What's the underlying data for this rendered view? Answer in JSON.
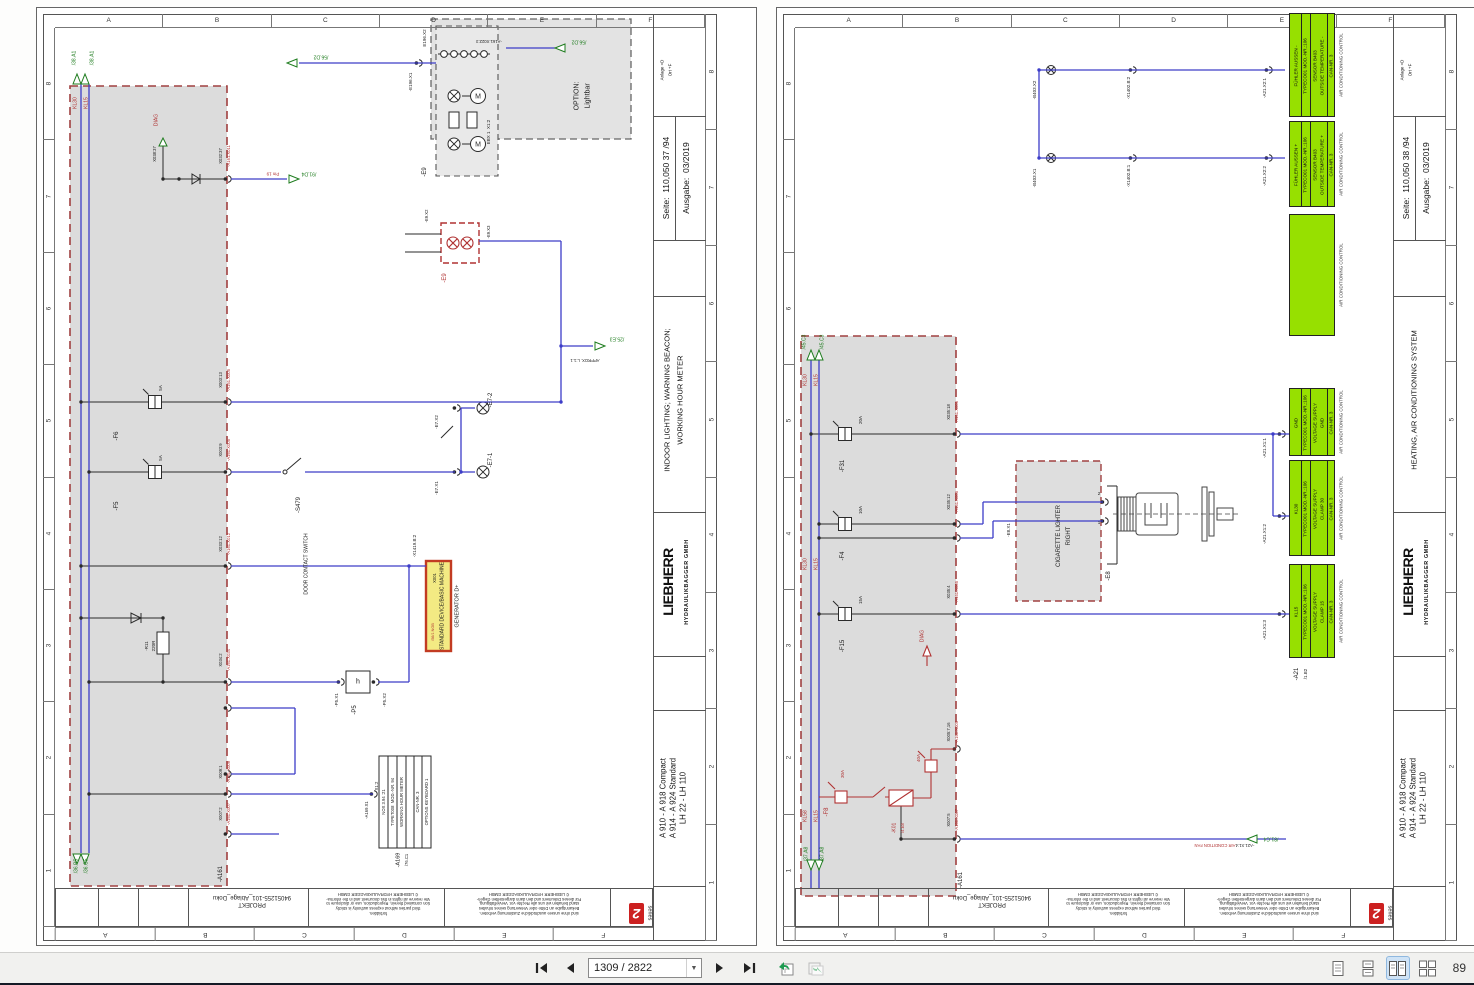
{
  "toolbar": {
    "page_input": "1309 / 2822",
    "zoom_value": "89"
  },
  "sheet_letters": [
    "A",
    "B",
    "C",
    "D",
    "E",
    "F"
  ],
  "sheet_numbers": [
    "8",
    "7",
    "6",
    "5",
    "4",
    "3",
    "2",
    "1"
  ],
  "footer_shared": {
    "projekt_lines": [
      "PROJEKT",
      "94051255-101_Ablage_Doku"
    ],
    "copyright_en": [
      "forbidden.",
      "third parties without express authority is strictly",
      "tion contained therein. Reproduction, use or disclosure to",
      "We reserve all rights in this document and in the informa-",
      "© LIEBHERR HYDRAULIKBAGGER GMBH"
    ],
    "copyright_de": [
      "sind ohne unsere ausdrückliche Zustimmung verboten.",
      "Bekanntgabe an Dritte oder Verwertung seines Inhaltes",
      "stand behalten wir uns alle Rechte vor. Vervielfältigung,",
      "Für dieses Dokument und den darin dargestellten Gegen-",
      "© LIEBHERR HYDRAULIKBAGGER GMBH"
    ],
    "series_word": "series",
    "series_digit": "2"
  },
  "pages": [
    {
      "sheet_id": "110.050 37",
      "title_block": {
        "anlage": "Anlage   =D",
        "ort": "Ort   +F",
        "seite_label": "Seite:",
        "seite_value": "110,050 37   /94",
        "ausgabe_label": "Ausgabe:",
        "ausgabe_value": "03/2019",
        "description_lines": [
          "INDOOR LIGHTING; WARNING BEACON;",
          "WORKING HOUR METER"
        ],
        "brand": "LIEBHERR",
        "brand_sub": "HYDRAULIKBAGGER  GMBH",
        "models": [
          "A 910 - A 918 Compact",
          "A 914 - A 924 Standard",
          "LH 22 - LH 110"
        ]
      },
      "labels": [
        {
          "t": "/38.A1",
          "x": 38,
          "y": 50,
          "c": "g"
        },
        {
          "t": "/38.A1",
          "x": 56,
          "y": 50,
          "c": "g"
        },
        {
          "t": "KL30",
          "x": 39,
          "y": 95,
          "c": "r"
        },
        {
          "t": "KL15",
          "x": 50,
          "y": 95,
          "c": "r"
        },
        {
          "t": "DIAG",
          "x": 120,
          "y": 112,
          "c": "r"
        },
        {
          "t": "X038:37",
          "x": 118,
          "y": 146,
          "c": "k",
          "s": 4.2
        },
        {
          "t": "X032:37",
          "x": 184,
          "y": 148,
          "c": "k",
          "s": 4.2
        },
        {
          "t": "-A161.X011",
          "x": 192,
          "y": 148,
          "c": "r",
          "s": 4.2
        },
        {
          "t": "Pin 19",
          "x": 236,
          "y": 165,
          "c": "r",
          "r": "u",
          "s": 4.5
        },
        {
          "t": "/91.D4",
          "x": 272,
          "y": 165,
          "c": "g",
          "r": "u"
        },
        {
          "t": "/56.D2",
          "x": 284,
          "y": 48,
          "c": "g",
          "r": "u"
        },
        {
          "t": "-E196.X1",
          "x": 374,
          "y": 74,
          "c": "k",
          "s": 4.5
        },
        {
          "t": "E196.X2",
          "x": 388,
          "y": 30,
          "c": "k",
          "s": 4.5
        },
        {
          "t": "EBX 1  X1:2",
          "x": 452,
          "y": 124,
          "c": "k",
          "s": 4.5
        },
        {
          "t": "OPTION:",
          "x": 540,
          "y": 88,
          "c": "k",
          "s": 7
        },
        {
          "t": "Lightbar",
          "x": 551,
          "y": 88,
          "c": "k",
          "s": 7
        },
        {
          "t": "-E9",
          "x": 388,
          "y": 164,
          "c": "k",
          "s": 6
        },
        {
          "t": "/56.D2",
          "x": 542,
          "y": 33,
          "c": "g",
          "r": "u"
        },
        {
          "t": "-A161.X022:3",
          "x": 452,
          "y": 33,
          "c": "k",
          "r": "u",
          "s": 4.2
        },
        {
          "t": "-E9.X2",
          "x": 390,
          "y": 208,
          "c": "k",
          "s": 4.2
        },
        {
          "t": "-E9.X3",
          "x": 452,
          "y": 224,
          "c": "k",
          "s": 4.2
        },
        {
          "t": "-E9",
          "x": 408,
          "y": 270,
          "c": "r",
          "s": 6
        },
        {
          "t": "/25.E3",
          "x": 580,
          "y": 330,
          "c": "g",
          "r": "u"
        },
        {
          "t": "APPROX. L:1.1",
          "x": 548,
          "y": 352,
          "c": "k",
          "r": "u",
          "s": 4.2
        },
        {
          "t": "-E7-2",
          "x": 454,
          "y": 392,
          "c": "k",
          "s": 6
        },
        {
          "t": "-E7.X2",
          "x": 400,
          "y": 414,
          "c": "k",
          "s": 4.5
        },
        {
          "t": "-E7-1",
          "x": 454,
          "y": 452,
          "c": "k",
          "s": 6
        },
        {
          "t": "-E7.X1",
          "x": 400,
          "y": 480,
          "c": "k",
          "s": 4.5
        },
        {
          "t": "-S479",
          "x": 262,
          "y": 497,
          "c": "k",
          "s": 6
        },
        {
          "t": "DOOR CONTACT SWITCH",
          "x": 270,
          "y": 556,
          "c": "k",
          "s": 5
        },
        {
          "t": "-F6",
          "x": 80,
          "y": 428,
          "c": "k",
          "s": 6
        },
        {
          "t": "5A",
          "x": 124,
          "y": 380,
          "c": "k",
          "s": 4.5
        },
        {
          "t": "-F5",
          "x": 80,
          "y": 498,
          "c": "k",
          "s": 6
        },
        {
          "t": "5A",
          "x": 124,
          "y": 450,
          "c": "k",
          "s": 4.5
        },
        {
          "t": "-R11",
          "x": 110,
          "y": 638,
          "c": "k",
          "s": 4.5
        },
        {
          "t": "220R",
          "x": 117,
          "y": 638,
          "c": "k",
          "s": 4.5
        },
        {
          "t": "-P5",
          "x": 318,
          "y": 702,
          "c": "k",
          "s": 6
        },
        {
          "t": "-P5.X1",
          "x": 300,
          "y": 692,
          "c": "k",
          "s": 4.5
        },
        {
          "t": "-P5.X2",
          "x": 348,
          "y": 692,
          "c": "k",
          "s": 4.5
        },
        {
          "t": "h",
          "x": 321,
          "y": 674,
          "c": "k",
          "r": "h",
          "s": 7
        },
        {
          "t": "-X1419.B:2",
          "x": 378,
          "y": 538,
          "c": "k",
          "s": 4.5
        },
        {
          "t": "X001",
          "x": 398,
          "y": 570,
          "c": "k",
          "s": 4.2
        },
        {
          "t": "/56/1 NGB",
          "x": 397,
          "y": 624,
          "c": "r",
          "s": 3.8
        },
        {
          "t": "STANDARD DEVICE/BASIC MACHINE",
          "x": 406,
          "y": 598,
          "c": "k",
          "s": 5
        },
        {
          "t": "GENERATOR D+",
          "x": 421,
          "y": 598,
          "c": "k",
          "s": 5.5
        },
        {
          "t": "NOX 3.94 :21",
          "x": 347,
          "y": 794,
          "c": "k",
          "s": 4.2
        },
        {
          "t": "TYPET008  MOD.-NR. 94",
          "x": 356,
          "y": 794,
          "c": "k",
          "s": 4.2
        },
        {
          "t": "WORKING HOUR METER",
          "x": 365,
          "y": 794,
          "c": "k",
          "s": 4.2
        },
        {
          "t": "CAN-NR. 3",
          "x": 381,
          "y": 794,
          "c": "k",
          "s": 4.2
        },
        {
          "t": "OPTIONS KEYBOARD 1",
          "x": 390,
          "y": 794,
          "c": "k",
          "s": 4.2
        },
        {
          "t": "-A169",
          "x": 362,
          "y": 852,
          "c": "k",
          "s": 5.5
        },
        {
          "t": "/76.C1",
          "x": 370,
          "y": 852,
          "c": "k",
          "s": 4.2
        },
        {
          "t": "-A169.X1",
          "x": 330,
          "y": 802,
          "c": "k",
          "s": 4.2
        },
        {
          "t": "X1:2",
          "x": 340,
          "y": 778,
          "c": "k",
          "s": 4.2
        },
        {
          "t": "-A161",
          "x": 184,
          "y": 866,
          "c": "k",
          "s": 6
        },
        {
          "t": "X003:13",
          "x": 184,
          "y": 372,
          "c": "k",
          "s": 4.2
        },
        {
          "t": "-A161.X005",
          "x": 192,
          "y": 372,
          "c": "r",
          "s": 4.2
        },
        {
          "t": "X003:9",
          "x": 184,
          "y": 442,
          "c": "k",
          "s": 4.2
        },
        {
          "t": "-A161.X005",
          "x": 192,
          "y": 442,
          "c": "r",
          "s": 4.2
        },
        {
          "t": "X033:12",
          "x": 184,
          "y": 536,
          "c": "k",
          "s": 4.2
        },
        {
          "t": "-A161.X012",
          "x": 192,
          "y": 536,
          "c": "r",
          "s": 4.2
        },
        {
          "t": "X034:2",
          "x": 184,
          "y": 652,
          "c": "k",
          "s": 4.2
        },
        {
          "t": "-A161.X034",
          "x": 192,
          "y": 652,
          "c": "r",
          "s": 4.2
        },
        {
          "t": "X009:1",
          "x": 184,
          "y": 764,
          "c": "k",
          "s": 4.2
        },
        {
          "t": "-A161.X009",
          "x": 192,
          "y": 764,
          "c": "r",
          "s": 4.2
        },
        {
          "t": "X007:2",
          "x": 184,
          "y": 806,
          "c": "k",
          "s": 4.2
        },
        {
          "t": "-A161.X007",
          "x": 192,
          "y": 806,
          "c": "r",
          "s": 4.2
        },
        {
          "t": "/36.B5",
          "x": 40,
          "y": 858,
          "c": "g"
        },
        {
          "t": "/36.C5",
          "x": 50,
          "y": 858,
          "c": "g"
        }
      ]
    },
    {
      "sheet_id": "110.050 38",
      "title_block": {
        "anlage": "Anlage   =D",
        "ort": "Ort   +F",
        "seite_label": "Seite:",
        "seite_value": "110,050 38   /94",
        "ausgabe_label": "Ausgabe:",
        "ausgabe_value": "03/2019",
        "description_lines": [
          "HEATING, AIR CONDITIONING SYSTEM",
          ""
        ],
        "brand": "LIEBHERR",
        "brand_sub": "HYDRAULIKBAGGER  GMBH",
        "models": [
          "A 910 - A 918 Compact",
          "A 914 - A 924 Standard",
          "LH 22 - LH 110"
        ]
      },
      "green_blocks": [
        {
          "y": 5,
          "h": 104,
          "name": "FÜHLER AUSSEN -",
          "type": "TYPECO01   MOD.-NR.:106",
          "desc1": "SENSOR B403",
          "desc2": "OUTSIDE TEMPERATURE -",
          "can": "CAN-NR. 3",
          "caption": "AIR CONDITIONING CONTROL"
        },
        {
          "y": 113,
          "h": 86,
          "name": "FÜHLER AUSSEN +",
          "type": "TYPECO01   MOD.-NR.:106",
          "desc1": "SENSOR B403",
          "desc2": "OUTSIDE TEMPERATURE +",
          "can": "CAN-NR. 3",
          "caption": "AIR CONDITIONING CONTROL"
        },
        {
          "y": 206,
          "h": 122,
          "empty": true,
          "caption": "AIR CONDITIONING CONTROL"
        },
        {
          "y": 380,
          "h": 68,
          "name": "GND",
          "type": "TYPECO01   MOD.-NR.:106",
          "desc1": "VOLTAGE SUPPLY",
          "desc2": "GND",
          "can": "CAN-NR. 3",
          "caption": "AIR CONDITIONING CONTROL"
        },
        {
          "y": 452,
          "h": 96,
          "name": "KL30",
          "type": "TYPECO01   MOD.-NR.:106",
          "desc1": "VOLTAGE SUPPLY",
          "desc2": "CLAMP 30",
          "can": "CAN-NR. 3",
          "caption": "AIR CONDITIONING CONTROL"
        },
        {
          "y": 556,
          "h": 94,
          "name": "KL15",
          "type": "TYPECO01   MOD.-NR.:106",
          "desc1": "VOLTAGE SUPPLY",
          "desc2": "CLAMP 15",
          "can": "CAN-NR. 3",
          "caption": "AIR CONDITIONING CONTROL"
        }
      ],
      "labels": [
        {
          "t": "/45.C3",
          "x": 28,
          "y": 334,
          "c": "g"
        },
        {
          "t": "/45.C3",
          "x": 46,
          "y": 334,
          "c": "g"
        },
        {
          "t": "KL30",
          "x": 29,
          "y": 372,
          "c": "r"
        },
        {
          "t": "KL15",
          "x": 40,
          "y": 372,
          "c": "r"
        },
        {
          "t": "KL30",
          "x": 29,
          "y": 556,
          "c": "r"
        },
        {
          "t": "KL15",
          "x": 40,
          "y": 556,
          "c": "r"
        },
        {
          "t": "-F31",
          "x": 66,
          "y": 458,
          "c": "k",
          "s": 6
        },
        {
          "t": "20A",
          "x": 84,
          "y": 412,
          "c": "k",
          "s": 4.5
        },
        {
          "t": "-F4",
          "x": 66,
          "y": 548,
          "c": "k",
          "s": 6
        },
        {
          "t": "10A",
          "x": 84,
          "y": 502,
          "c": "k",
          "s": 4.5
        },
        {
          "t": "-F15",
          "x": 66,
          "y": 638,
          "c": "k",
          "s": 6
        },
        {
          "t": "15A",
          "x": 84,
          "y": 592,
          "c": "k",
          "s": 4.5
        },
        {
          "t": "X035:18",
          "x": 172,
          "y": 404,
          "c": "k",
          "s": 4.2
        },
        {
          "t": "-A161.X005",
          "x": 180,
          "y": 404,
          "c": "r",
          "s": 4.2
        },
        {
          "t": "X035:12",
          "x": 172,
          "y": 494,
          "c": "k",
          "s": 4.2
        },
        {
          "t": "-A161.X005",
          "x": 180,
          "y": 494,
          "c": "r",
          "s": 4.2
        },
        {
          "t": "X035:4",
          "x": 172,
          "y": 584,
          "c": "k",
          "s": 4.2
        },
        {
          "t": "-A161.X005",
          "x": 180,
          "y": 584,
          "c": "r",
          "s": 4.2
        },
        {
          "t": "DIAG",
          "x": 146,
          "y": 628,
          "c": "r"
        },
        {
          "t": "-F8",
          "x": 50,
          "y": 804,
          "c": "r",
          "s": 6
        },
        {
          "t": "30A",
          "x": 66,
          "y": 766,
          "c": "r",
          "s": 4.5
        },
        {
          "t": "40A",
          "x": 142,
          "y": 750,
          "c": "r",
          "s": 4.5
        },
        {
          "t": "-K01",
          "x": 118,
          "y": 820,
          "c": "r",
          "s": 5
        },
        {
          "t": "/4.E8",
          "x": 126,
          "y": 820,
          "c": "r",
          "s": 4.2
        },
        {
          "t": "X005:7,16",
          "x": 172,
          "y": 724,
          "c": "k",
          "s": 4.2
        },
        {
          "t": "-A161.X005",
          "x": 180,
          "y": 724,
          "c": "r",
          "s": 4.2
        },
        {
          "t": "X007:5",
          "x": 172,
          "y": 812,
          "c": "k",
          "s": 4.2
        },
        {
          "t": "-A161.X007",
          "x": 180,
          "y": 812,
          "c": "r",
          "s": 4.2
        },
        {
          "t": "-A161",
          "x": 184,
          "y": 872,
          "c": "k",
          "s": 6
        },
        {
          "t": "-B403.X2",
          "x": 258,
          "y": 82,
          "c": "k",
          "s": 4.5
        },
        {
          "t": "-B403.X1",
          "x": 258,
          "y": 170,
          "c": "k",
          "s": 4.5
        },
        {
          "t": "-X1402.B:2",
          "x": 352,
          "y": 80,
          "c": "k",
          "s": 4.5
        },
        {
          "t": "-X1402.B:1",
          "x": 352,
          "y": 168,
          "c": "k",
          "s": 4.5
        },
        {
          "t": "-A21.X2:1",
          "x": 488,
          "y": 80,
          "c": "k",
          "s": 4.5
        },
        {
          "t": "-A21.X2:2",
          "x": 488,
          "y": 168,
          "c": "k",
          "s": 4.5
        },
        {
          "t": "-A21.X1:1",
          "x": 488,
          "y": 440,
          "c": "k",
          "s": 4.5
        },
        {
          "t": "-A21.X1:2",
          "x": 488,
          "y": 526,
          "c": "k",
          "s": 4.5
        },
        {
          "t": "-A21.X1:3",
          "x": 488,
          "y": 622,
          "c": "k",
          "s": 4.5
        },
        {
          "t": "CIGARETTE LIGHTER",
          "x": 282,
          "y": 528,
          "c": "k",
          "s": 6
        },
        {
          "t": "RIGHT",
          "x": 292,
          "y": 528,
          "c": "k",
          "s": 6
        },
        {
          "t": "-E8.X1",
          "x": 232,
          "y": 522,
          "c": "k",
          "s": 4.5
        },
        {
          "t": "-E8",
          "x": 332,
          "y": 568,
          "c": "k",
          "s": 6
        },
        {
          "t": "2",
          "x": 322,
          "y": 486,
          "c": "k",
          "r": "h",
          "s": 4.5
        },
        {
          "t": "1",
          "x": 322,
          "y": 515,
          "c": "k",
          "r": "h",
          "s": 4.5
        },
        {
          "t": "-A21",
          "x": 520,
          "y": 666,
          "c": "k",
          "s": 6
        },
        {
          "t": "/1.B2",
          "x": 529,
          "y": 666,
          "c": "k",
          "s": 4.5
        },
        {
          "t": "AIR CONDITION FAN",
          "x": 438,
          "y": 837,
          "c": "r",
          "r": "u",
          "s": 4.2
        },
        {
          "t": "-A21.X1:4",
          "x": 468,
          "y": 837,
          "c": "k",
          "r": "u",
          "s": 4.2
        },
        {
          "t": "/81.C4",
          "x": 494,
          "y": 830,
          "c": "g",
          "r": "u"
        },
        {
          "t": "/37.A8",
          "x": 30,
          "y": 846,
          "c": "g"
        },
        {
          "t": "/37.A8",
          "x": 46,
          "y": 846,
          "c": "g"
        },
        {
          "t": "KL58",
          "x": 29,
          "y": 808,
          "c": "r"
        },
        {
          "t": "KL15",
          "x": 40,
          "y": 808,
          "c": "r"
        }
      ]
    }
  ]
}
